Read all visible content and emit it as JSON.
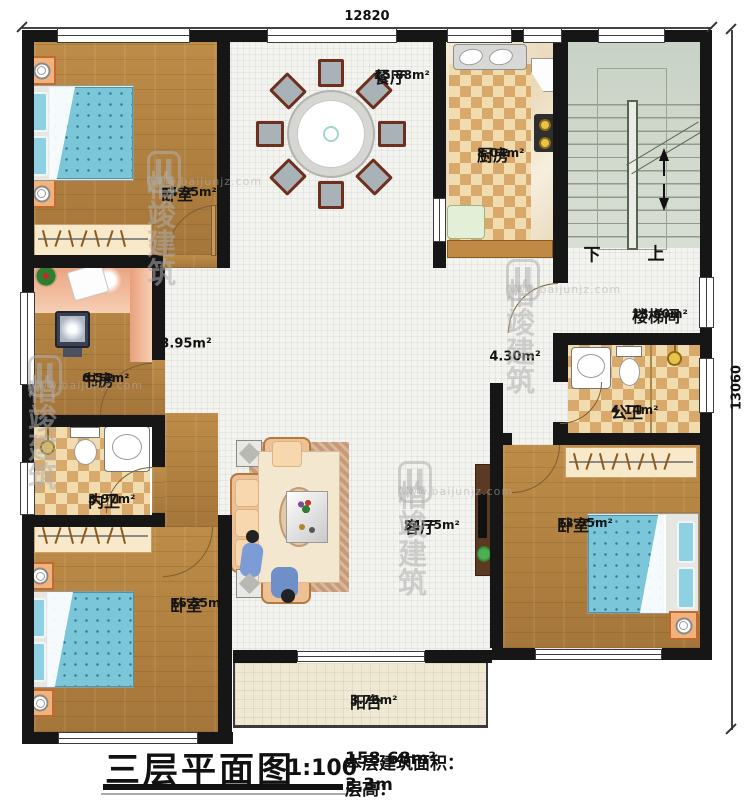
{
  "dimensions": {
    "top": "12820",
    "right": "13060"
  },
  "stairs": {
    "down": "下",
    "up": "上"
  },
  "rooms": [
    {
      "id": "bedroom-nw",
      "name": "卧室",
      "area": "14.95m²"
    },
    {
      "id": "dining",
      "name": "餐厅",
      "area": "15.88m²"
    },
    {
      "id": "kitchen",
      "name": "厨房",
      "area": "8.04m²"
    },
    {
      "id": "stairwell",
      "name": "楼梯间",
      "area": "13.60m²"
    },
    {
      "id": "study",
      "name": "书房",
      "area": "6.54m²"
    },
    {
      "id": "bath-private",
      "name": "内卫",
      "area": "3.97m²"
    },
    {
      "id": "bedroom-sw",
      "name": "卧室",
      "area": "16.55m²"
    },
    {
      "id": "living",
      "name": "客厅",
      "area": "34.75m²"
    },
    {
      "id": "bath-public",
      "name": "公卫",
      "area": "4.14m²"
    },
    {
      "id": "bedroom-se",
      "name": "卧室",
      "area": "13.95m²"
    },
    {
      "id": "balcony",
      "name": "阳台",
      "area": "3.76m²"
    }
  ],
  "halls": [
    {
      "area": "3.95m²"
    },
    {
      "area": "4.30m²"
    }
  ],
  "title_block": {
    "title": "三层平面图",
    "scale": "1:100",
    "area_label": "本层建筑面积：",
    "area_value": "158.68m²",
    "height_label": "层高：",
    "height_value": "3.3m"
  },
  "watermark": {
    "brand": "柏竣建筑",
    "url": "www.baijunjz.com"
  },
  "colors": {
    "wall": "#161616",
    "wood": "#b3823f",
    "tile": "#f3f3ef",
    "checker_dark": "#d9a96c",
    "stair": "#cdd5ca",
    "bed": "#7cc6da"
  }
}
